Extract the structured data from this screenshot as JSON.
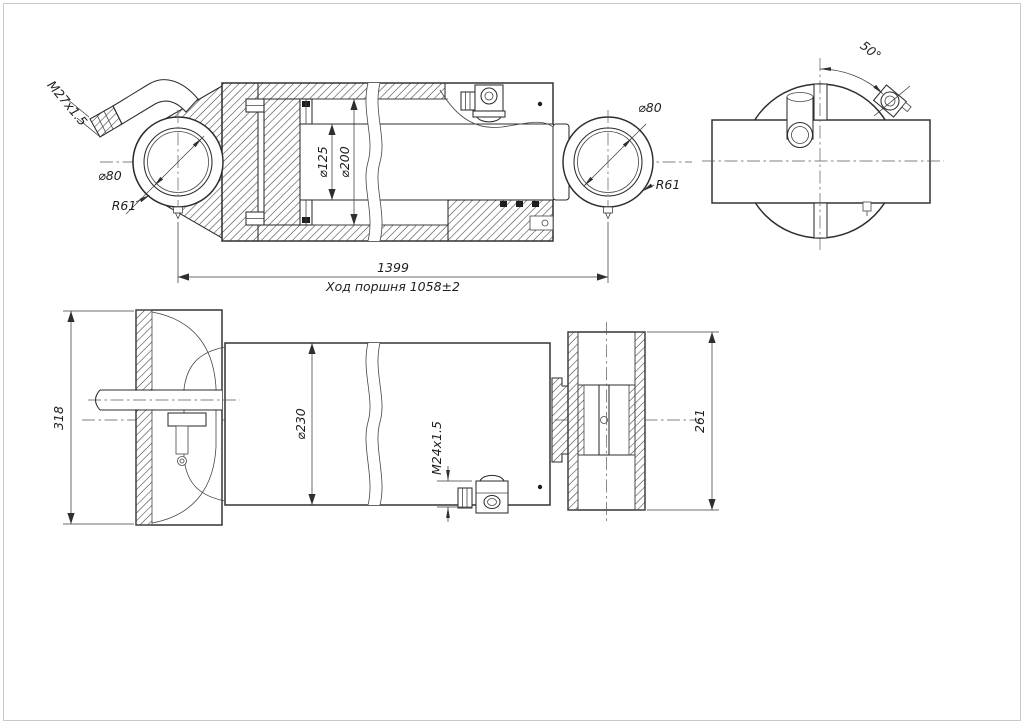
{
  "colors": {
    "line": "#2d2d2d",
    "thin_line": "#454545",
    "background": "#ffffff",
    "frame": "#c9c9c9"
  },
  "views": {
    "section": {
      "labels": {
        "port_thread": "M27x1.5",
        "eye_bore_left": "⌀80",
        "eye_radius_left": "R61",
        "rod_diameter": "⌀125",
        "bore_diameter": "⌀200",
        "eye_bore_right": "⌀80",
        "eye_radius_right": "R61",
        "overall_length": "1399",
        "stroke_note": "Ход поршня 1058±2"
      }
    },
    "end_view": {
      "labels": {
        "port_angle": "50°"
      }
    },
    "side_view": {
      "labels": {
        "mount_width": "318",
        "body_diameter": "⌀230",
        "port_thread": "M24x1.5",
        "rod_eye_width": "261"
      }
    }
  }
}
